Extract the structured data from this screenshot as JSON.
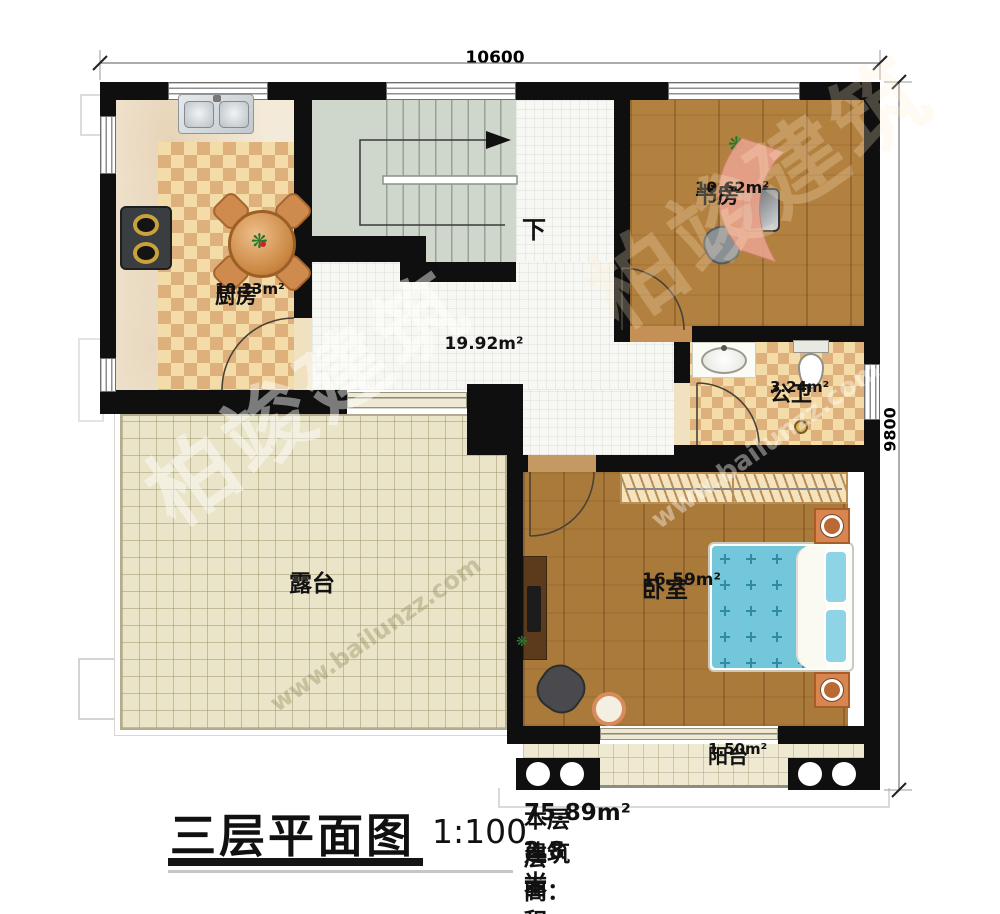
{
  "palette": {
    "wall": "#0f0f0f",
    "marble": "#f4ead9",
    "checker-light": "#f3dca8",
    "checker-dark": "#ddb07c",
    "tile-hall": "#f7f7f3",
    "wood-study": "#b3813f",
    "wood-bedroom": "#aa7a3a",
    "stairs": "#cfd6cc",
    "terrace": "#eae4c8",
    "balcony": "#efe9d2",
    "bed": "#74c6db",
    "nightstand": "#d8854f"
  },
  "title_block": {
    "title": "三层平面图",
    "scale": "1:100",
    "area_label": "本层建筑面积：",
    "area_value": "75.89m²",
    "floor_height_label": "层高：",
    "floor_height_value": "2.8米"
  },
  "dimensions": {
    "width": "10600",
    "height": "9800"
  },
  "rooms": {
    "kitchen": {
      "name": "厨房",
      "area": "10.23m²"
    },
    "study": {
      "name": "书房",
      "area": "10.62m²"
    },
    "bathroom": {
      "name": "公卫",
      "area": "3.24m²"
    },
    "hall": {
      "area": "19.92m²"
    },
    "terrace": {
      "name": "露台"
    },
    "bedroom": {
      "name": "卧室",
      "area": "16.59m²"
    },
    "balcony": {
      "name": "阳台",
      "area": "1.50m²"
    },
    "stairs": {
      "direction": "下"
    }
  },
  "watermark": {
    "brand": "柏竣建筑",
    "site": "www.bailunzz.com"
  }
}
